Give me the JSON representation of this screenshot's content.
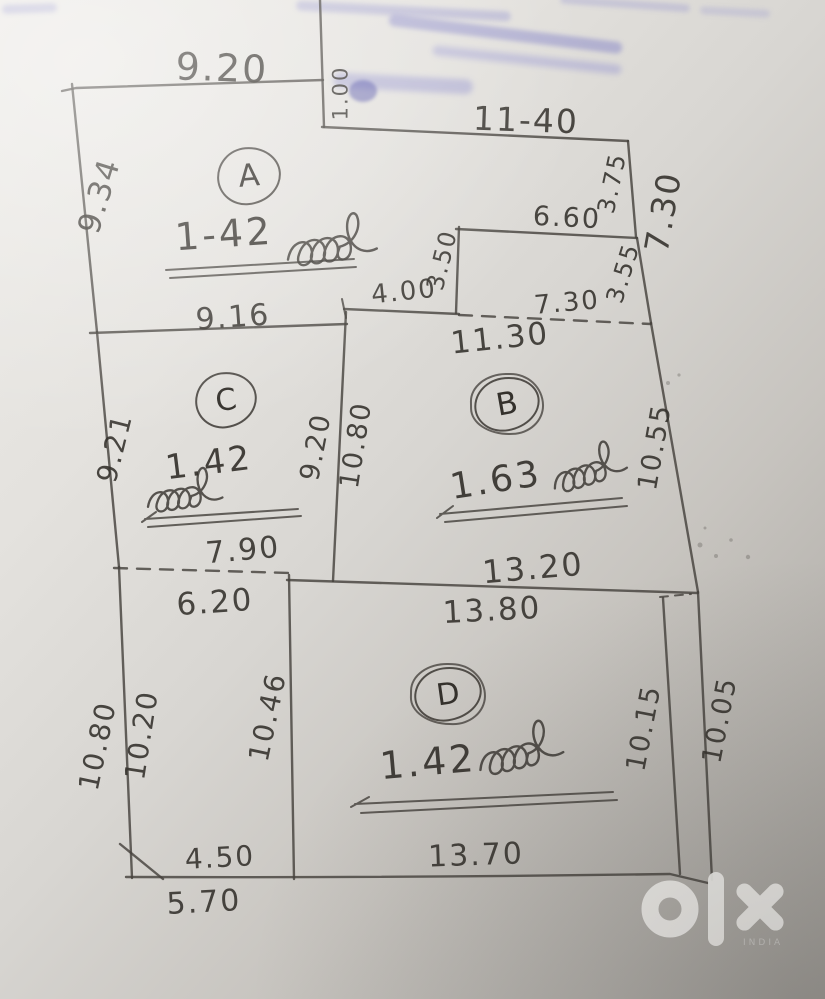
{
  "document": {
    "type": "hand-drawn land plot sketch photo",
    "colors": {
      "ink": "#45423d",
      "paper_light": "#edebe7",
      "paper_dark": "#a09d98",
      "blue_ink": "#6e6ec4",
      "watermark": "#f2f1ee"
    }
  },
  "plots": {
    "a": {
      "letter": "A",
      "value": "1-42"
    },
    "b": {
      "letter": "B",
      "value": "1.63"
    },
    "c": {
      "letter": "C",
      "value": "1.42"
    },
    "d": {
      "letter": "D",
      "value": "1.42"
    }
  },
  "dims": {
    "a_top": "9.20",
    "step": "1.00",
    "b_top": "11-40",
    "right_375": "3.75",
    "right_730": "7.30",
    "notch_top": "6.60",
    "notch_left": "3.50",
    "notch_right": "3.55",
    "inner_400": "4.00",
    "dash_730": "7.30",
    "total_1130": "11.30",
    "a_bottom": "9.16",
    "a_left": "9.34",
    "c_left": "9.21",
    "cb_left": "9.20",
    "cb_right": "10.80",
    "b_right": "10.55",
    "b_bottom": "13.20",
    "c_bottom": "7.90",
    "e_top": "6.20",
    "outer_left": "10.80",
    "e_left": "10.20",
    "e_right": "10.46",
    "d_top": "13.80",
    "d_right": "10.15",
    "outer_right": "10.05",
    "e_bottom_inner": "4.50",
    "e_bottom_outer": "5.70",
    "d_bottom": "13.70"
  },
  "watermark": {
    "logo": "olx",
    "country_label": "INDIA"
  }
}
